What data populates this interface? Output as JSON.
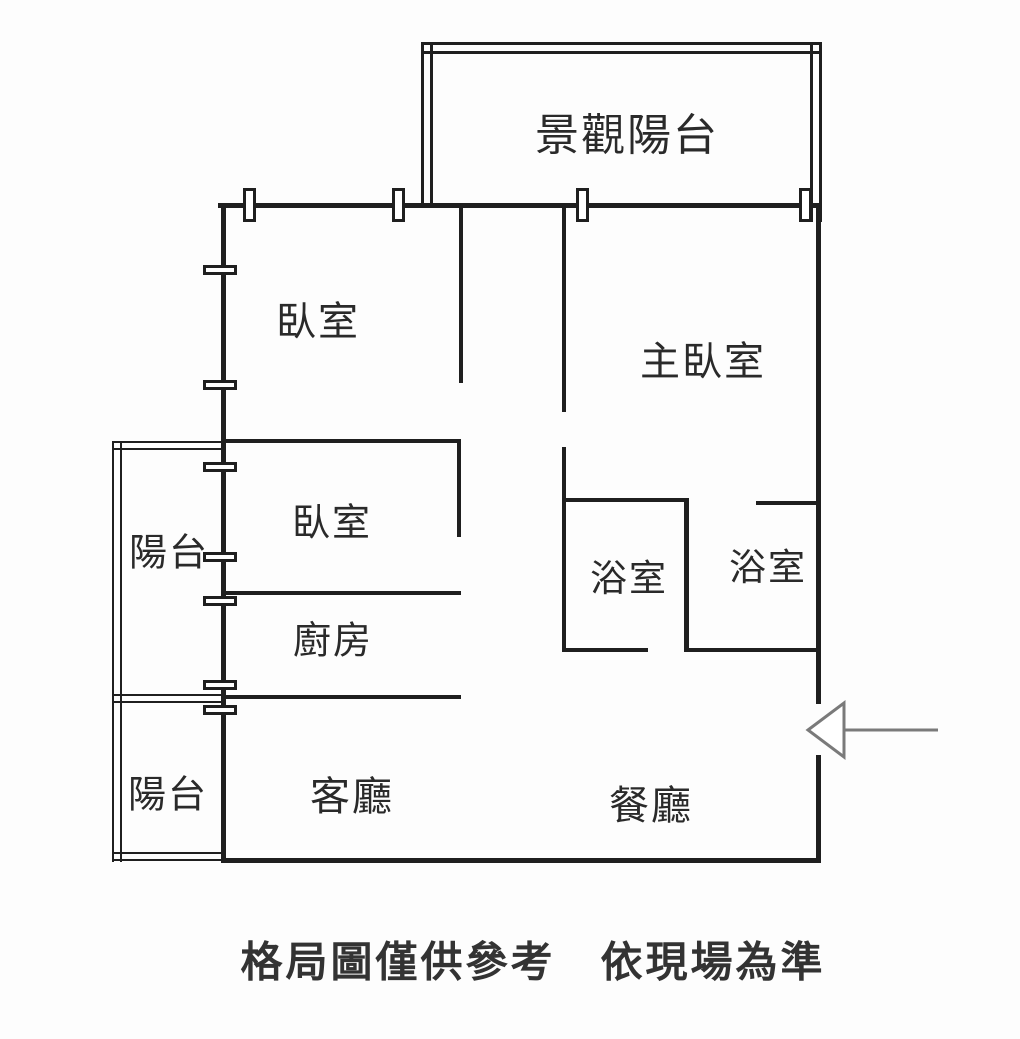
{
  "plan": {
    "title": "apartment-floor-plan",
    "rooms": {
      "scenic_balcony": "景觀陽台",
      "bedroom1": "臥室",
      "master_bedroom": "主臥室",
      "balcony_upper": "陽台",
      "bedroom2": "臥室",
      "kitchen": "廚房",
      "bathroom1": "浴室",
      "bathroom2": "浴室",
      "balcony_lower": "陽台",
      "living_room": "客廳",
      "dining_room": "餐廳"
    },
    "caption": "格局圖僅供參考　依現場為準",
    "icons": {
      "window": "window-symbol",
      "entrance_arrow": "left-pointing-entrance-arrow"
    }
  },
  "colors": {
    "wall": "#1f1f1f",
    "text": "#2a2a2a",
    "caption": "#333333",
    "arrow": "#7a7a7a",
    "background": "#fdfdfd"
  }
}
